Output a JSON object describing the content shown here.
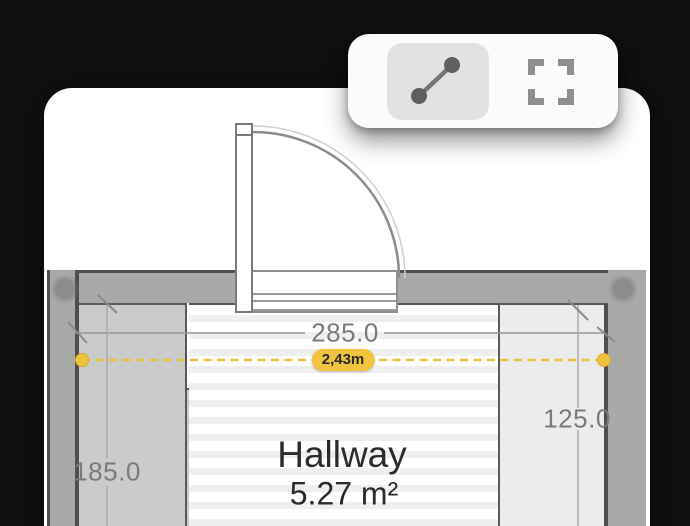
{
  "toolbar": {
    "tools": [
      {
        "id": "measure",
        "icon": "measure-line-icon",
        "selected": true
      },
      {
        "id": "select-area",
        "icon": "marquee-icon",
        "selected": false
      }
    ]
  },
  "plan": {
    "room_name": "Hallway",
    "room_area": "5.27 m²",
    "dim_top": "285.0",
    "dim_left": "185.0",
    "dim_right": "125.0",
    "measurement_value": "2,43m"
  },
  "colors": {
    "measurement_accent": "#F0C43E",
    "wall": "#A9A9A9",
    "background": "#0F110F"
  }
}
